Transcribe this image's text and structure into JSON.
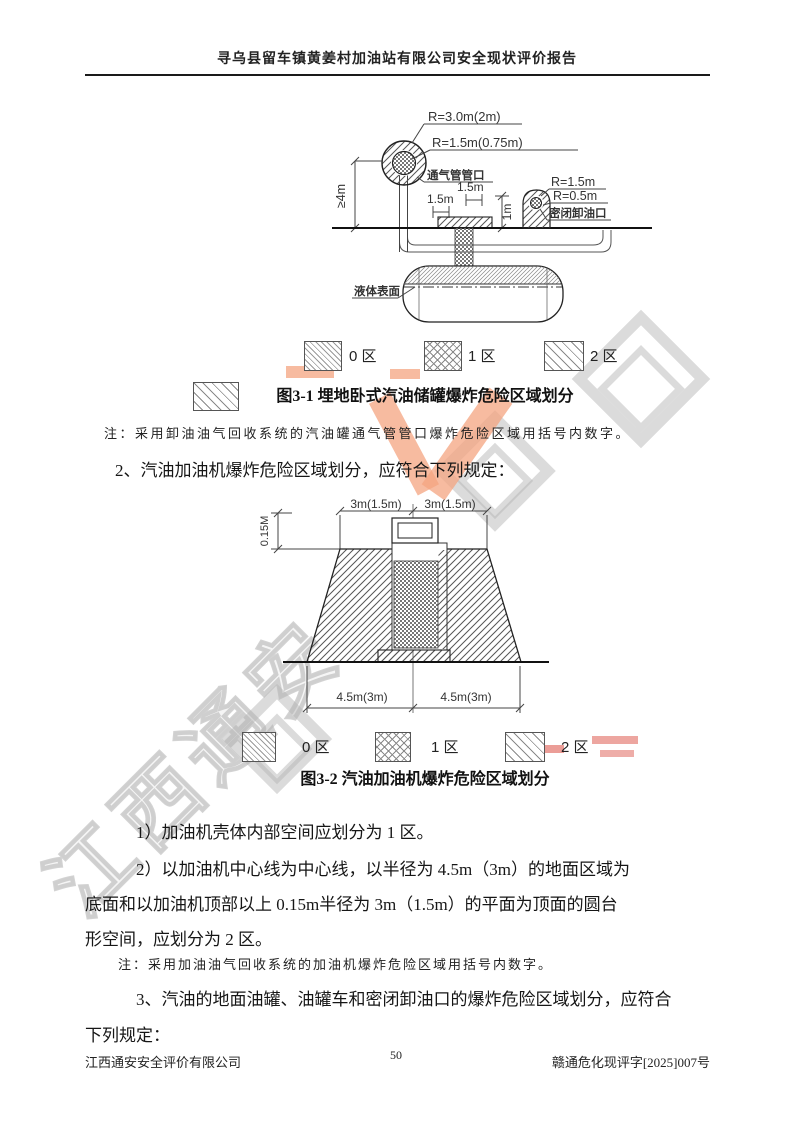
{
  "header": {
    "title": "寻乌县留车镇黄姜村加油站有限公司安全现状评价报告"
  },
  "figure1": {
    "labels": {
      "r_outer": "R=3.0m(2m)",
      "r_inner": "R=1.5m(0.75m)",
      "vent_port": "通气管管口",
      "dim_1_5": "1.5m",
      "dim_1m": "1m",
      "dim_4m": "≥4m",
      "r_unload_outer": "R=1.5m",
      "r_unload_inner": "R=0.5m",
      "unload_port": "密闭卸油口",
      "liquid_surface": "液体表面"
    },
    "legend": [
      {
        "label": "0 区"
      },
      {
        "label": "1 区"
      },
      {
        "label": "2 区"
      }
    ],
    "caption": "图3-1  埋地卧式汽油储罐爆炸危险区域划分",
    "note": "注：采用卸油油气回收系统的汽油罐通气管管口爆炸危险区域用括号内数字。"
  },
  "section2_heading": "2、汽油加油机爆炸危险区域划分，应符合下列规定：",
  "figure2": {
    "labels": {
      "dim_top": "3m(1.5m)",
      "dim_height": "0.15M",
      "dim_bottom": "4.5m(3m)"
    },
    "legend": [
      {
        "label": "0 区"
      },
      {
        "label": "1 区"
      },
      {
        "label": "2 区"
      }
    ],
    "caption": "图3-2  汽油加油机爆炸危险区域划分"
  },
  "body": {
    "item1": "1）加油机壳体内部空间应划分为 1 区。",
    "item2_lines": [
      "2）以加油机中心线为中心线，以半径为 4.5m（3m）的地面区域为",
      "底面和以加油机顶部以上 0.15m半径为 3m（1.5m）的平面为顶面的圆台",
      "形空间，应划分为 2 区。"
    ],
    "note2": "注：采用加油油气回收系统的加油机爆炸危险区域用括号内数字。",
    "item3_lines": [
      "3、汽油的地面油罐、油罐车和密闭卸油口的爆炸危险区域划分，应符合",
      "下列规定："
    ]
  },
  "footer": {
    "company": "江西通安安全评价有限公司",
    "page_number": "50",
    "doc_number": "赣通危化现评字[2025]007号"
  },
  "watermark": {
    "text": "江西通安"
  },
  "colors": {
    "watermark_gray": "#c0c0c0",
    "watermark_salmon": "#f2a183",
    "line_dark": "#222222"
  }
}
